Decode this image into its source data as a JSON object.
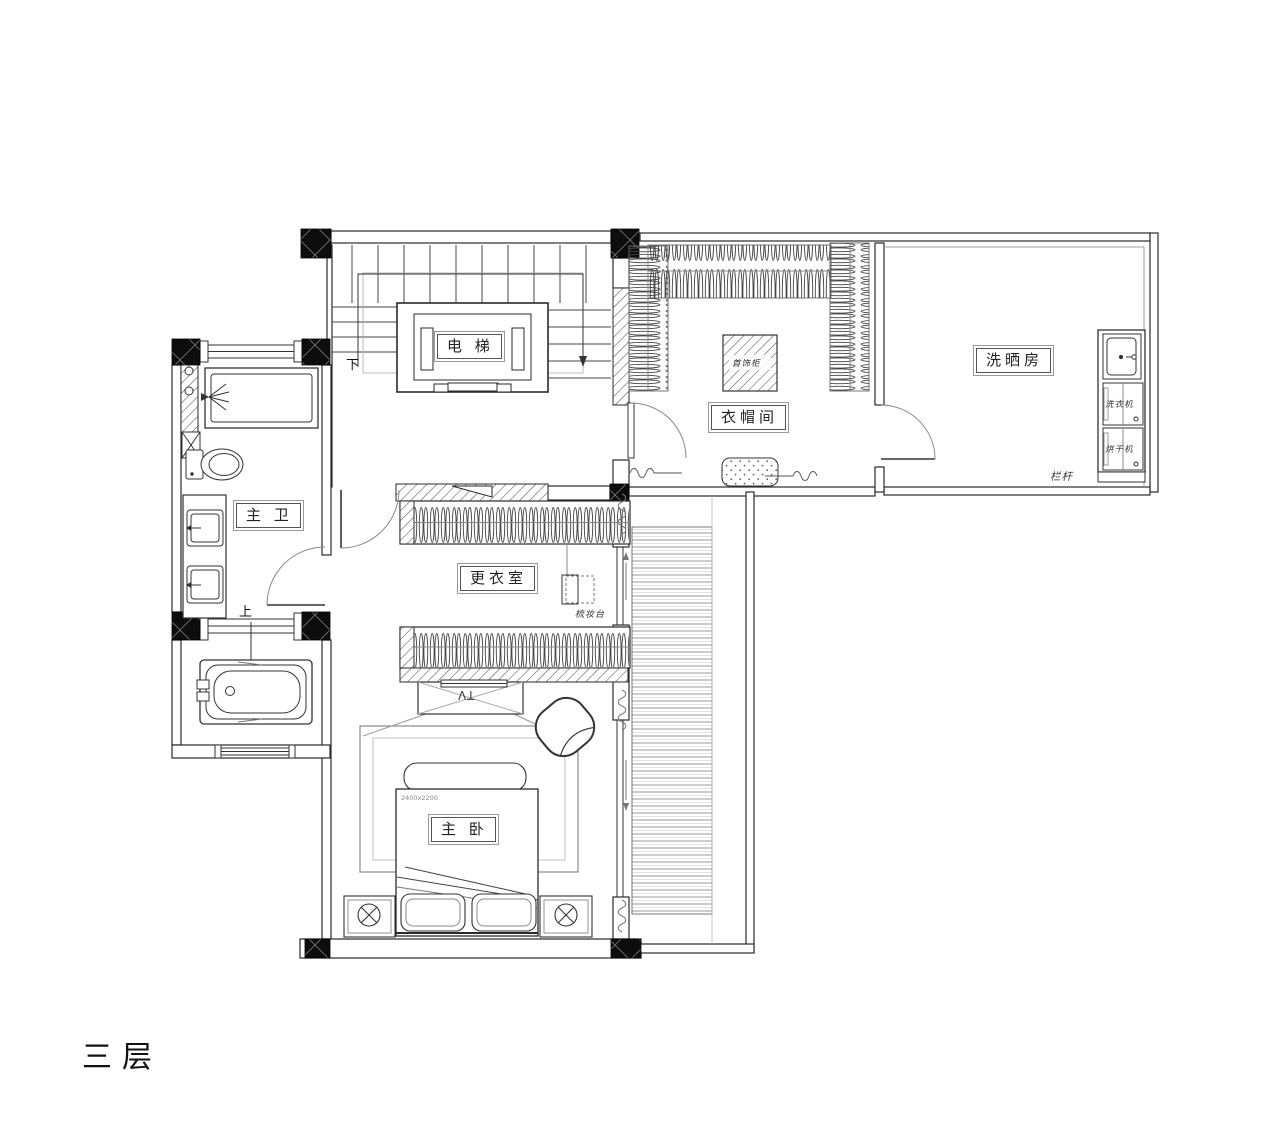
{
  "floor": {
    "title": "三层"
  },
  "rooms": {
    "elevator": {
      "label": "电 梯"
    },
    "cloakroom": {
      "label": "衣帽间",
      "jewelry_cabinet_label": "首饰柜"
    },
    "laundry": {
      "label": "洗晒房",
      "washer_label": "洗衣机",
      "dryer_label": "烘干机",
      "railing_label": "栏杆"
    },
    "master_bath": {
      "label": "主 卫"
    },
    "dressing_room": {
      "label": "更衣室",
      "dressing_table_label": "梳妆台"
    },
    "master_bedroom": {
      "label": "主 卧",
      "tv_label": "TV",
      "bed_size_label": "2400x2200"
    }
  },
  "stairs": {
    "down_label": "下",
    "up_label": "上"
  },
  "colors": {
    "line": "#333333",
    "line_light": "#999999",
    "background": "#ffffff",
    "column_fill": "#0d0d0d"
  }
}
